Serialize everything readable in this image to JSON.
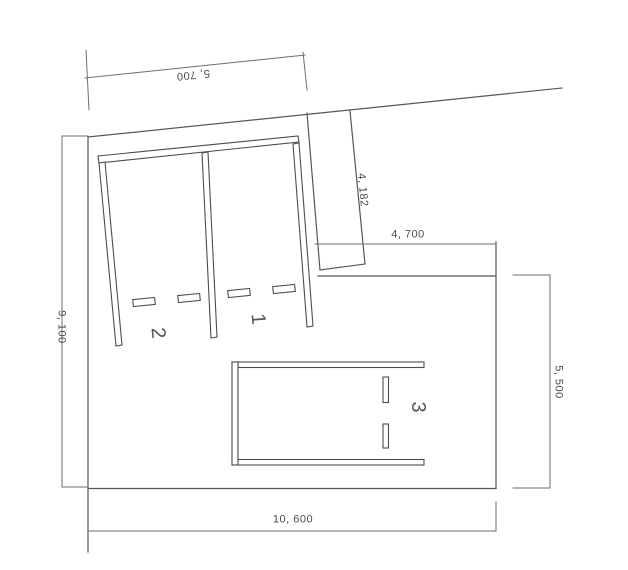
{
  "drawing": {
    "dimensions": {
      "top": "5, 700",
      "edge_slant": "4, 182",
      "inner_width": "4, 700",
      "left_height": "9, 100",
      "right_height": "5, 500",
      "bottom_width": "10, 600"
    },
    "stall_labels": {
      "one": "1",
      "two": "2",
      "three": "3"
    },
    "colors": {
      "line": "#565656",
      "dimension_line": "#6e6e6e",
      "text": "#4a4a4a",
      "background": "#ffffff"
    }
  }
}
